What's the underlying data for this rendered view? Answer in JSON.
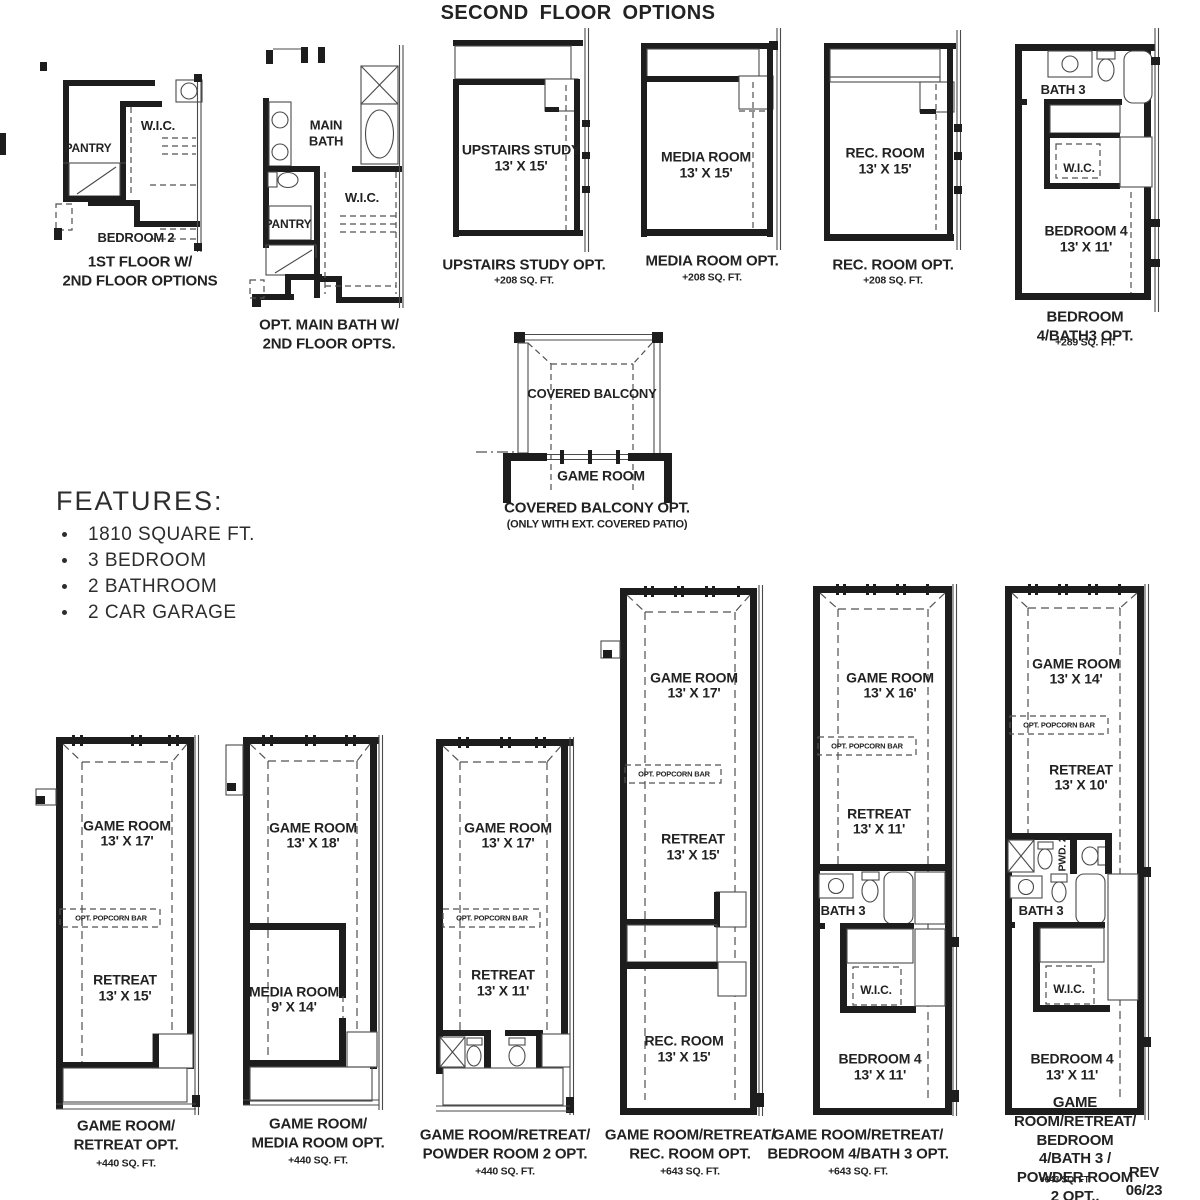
{
  "title": "SECOND FLOOR OPTIONS",
  "rev_note": "REV 06/23 (40SA)",
  "features": {
    "heading": "FEATURES:",
    "items": [
      "1810 SQUARE FT.",
      "3 BEDROOM",
      "2 BATHROOM",
      "2 CAR GARAGE"
    ]
  },
  "plans": {
    "first_floor_opts": {
      "pantry": "PANTRY",
      "wic": "W.I.C.",
      "bedroom": "BEDROOM 2",
      "caption": "1ST FLOOR W/\n2ND FLOOR OPTIONS"
    },
    "opt_main_bath": {
      "main_bath": "MAIN\nBATH",
      "pantry": "PANTRY",
      "wic": "W.I.C.",
      "caption": "OPT. MAIN BATH W/\n2ND FLOOR OPTS."
    },
    "upstairs_study": {
      "room": "UPSTAIRS STUDY",
      "dims": "13' X 15'",
      "caption": "UPSTAIRS STUDY OPT.",
      "sqft": "+208 SQ. FT."
    },
    "media_room": {
      "room": "MEDIA ROOM",
      "dims": "13' X 15'",
      "caption": "MEDIA ROOM OPT.",
      "sqft": "+208 SQ. FT."
    },
    "rec_room": {
      "room": "REC. ROOM",
      "dims": "13' X 15'",
      "caption": "REC. ROOM OPT.",
      "sqft": "+208 SQ. FT."
    },
    "bedroom4_bath3": {
      "bath": "BATH 3",
      "wic": "W.I.C.",
      "room": "BEDROOM 4",
      "dims": "13' X 11'",
      "caption": "BEDROOM 4/BATH3 OPT.",
      "sqft": "+289 SQ. FT."
    },
    "covered_balcony": {
      "balcony": "COVERED BALCONY",
      "game": "GAME ROOM",
      "caption": "COVERED BALCONY OPT.",
      "note": "(ONLY WITH EXT. COVERED PATIO)"
    },
    "game_retreat": {
      "game": "GAME ROOM",
      "game_dims": "13' X 17'",
      "popcorn": "OPT. POPCORN BAR",
      "retreat": "RETREAT",
      "retreat_dims": "13' X 15'",
      "caption": "GAME ROOM/\nRETREAT OPT.",
      "sqft": "+440 SQ. FT."
    },
    "game_media": {
      "game": "GAME ROOM",
      "game_dims": "13' X 18'",
      "media": "MEDIA ROOM",
      "media_dims": "9' X 14'",
      "caption": "GAME ROOM/\nMEDIA ROOM OPT.",
      "sqft": "+440 SQ. FT."
    },
    "game_retreat_powder": {
      "game": "GAME ROOM",
      "game_dims": "13' X 17'",
      "popcorn": "OPT. POPCORN BAR",
      "retreat": "RETREAT",
      "retreat_dims": "13' X 11'",
      "caption": "GAME ROOM/RETREAT/\nPOWDER ROOM 2 OPT.",
      "sqft": "+440 SQ. FT."
    },
    "game_retreat_rec": {
      "game": "GAME ROOM",
      "game_dims": "13' X 17'",
      "popcorn": "OPT. POPCORN BAR",
      "retreat": "RETREAT",
      "retreat_dims": "13' X 15'",
      "rec": "REC. ROOM",
      "rec_dims": "13' X 15'",
      "caption": "GAME ROOM/RETREAT/\nREC. ROOM OPT.",
      "sqft": "+643 SQ. FT."
    },
    "game_retreat_bed4": {
      "game": "GAME ROOM",
      "game_dims": "13' X 16'",
      "popcorn": "OPT. POPCORN BAR",
      "retreat": "RETREAT",
      "retreat_dims": "13' X 11'",
      "bath": "BATH 3",
      "wic": "W.I.C.",
      "bed": "BEDROOM 4",
      "bed_dims": "13' X 11'",
      "caption": "GAME ROOM/RETREAT/\nBEDROOM 4/BATH 3 OPT.",
      "sqft": "+643 SQ. FT."
    },
    "game_retreat_bed4_powder": {
      "game": "GAME ROOM",
      "game_dims": "13' X 14'",
      "popcorn": "OPT. POPCORN BAR",
      "retreat": "RETREAT",
      "retreat_dims": "13' X 10'",
      "pwd": "PWD. 2",
      "bath": "BATH 3",
      "wic": "W.I.C.",
      "bed": "BEDROOM 4",
      "bed_dims": "13' X 11'",
      "caption": "GAME ROOM/RETREAT/\nBEDROOM 4/BATH 3 /\nPOWDER ROOM 2 OPT..",
      "sqft": "+643 SQ. FT."
    }
  }
}
